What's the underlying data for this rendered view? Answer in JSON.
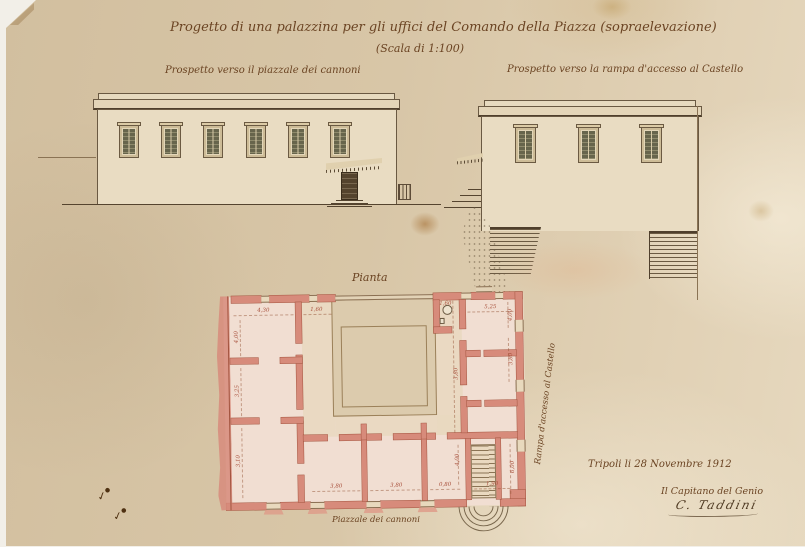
{
  "document": {
    "title": "Progetto di una palazzina per gli uffici del Comando della Piazza (sopraelevazione)",
    "scale_note": "(Scala di 1:100)",
    "elevation_left_label": "Prospetto verso il piazzale dei cannoni",
    "elevation_right_label": "Prospetto verso la rampa d'accesso al Castello",
    "plan_title": "Pianta",
    "ramp_annotation": "Rampa d'accesso al Castello",
    "square_annotation": "Piazzale dei cannoni",
    "place_date": "Tripoli li 28 Novembre 1912",
    "signature_role": "Il Capitano del Genio",
    "signature_name": "C. Taddini"
  },
  "plan": {
    "dimensions": [
      "4,30",
      "1,60",
      "4,00",
      "3,25",
      "3,10",
      "1,60",
      "5,25",
      "4,00",
      "3,80",
      "6,00",
      "3,80",
      "3,80",
      "0,80",
      "4,00",
      "1,90",
      "3,80"
    ]
  },
  "colors": {
    "paper": "#d8c6a7",
    "ink": "#55442f",
    "text_ink": "#6b4423",
    "wall_pink": "#d78b7b",
    "floor_wash": "#f1ded2",
    "facade_cream": "#e9dcc2",
    "shutter_olive": "#67654c",
    "dimension_red": "#a8503c"
  }
}
